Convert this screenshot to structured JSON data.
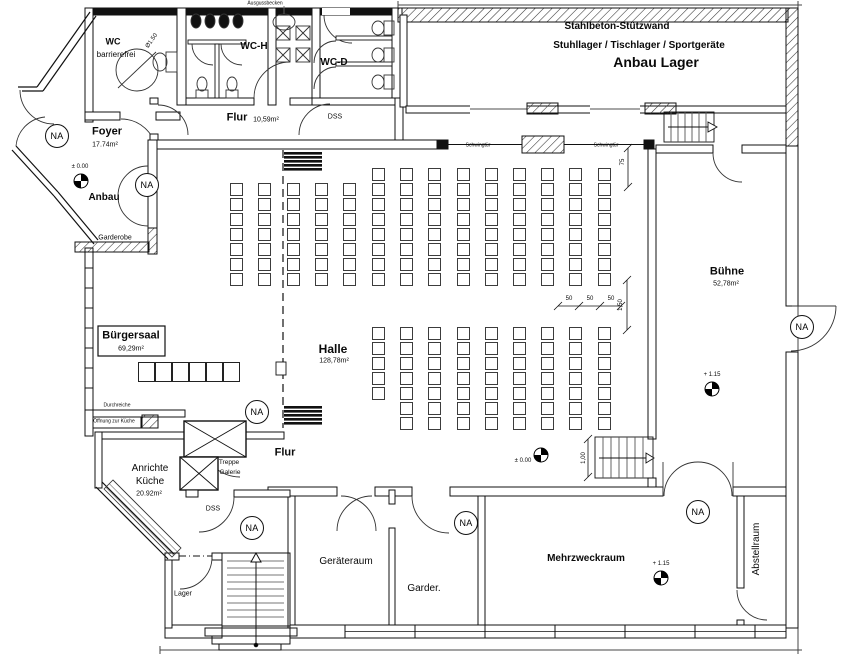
{
  "na_label": "NA",
  "labels": [
    {
      "id": "ausgussbecken",
      "text": "Ausgussbecken",
      "x": 265,
      "y": 4,
      "size": 5
    },
    {
      "id": "wc-line1",
      "text": "WC",
      "x": 113,
      "y": 42,
      "size": 9,
      "weight": 700
    },
    {
      "id": "wc-line2",
      "text": "barrierefrei",
      "x": 116,
      "y": 55,
      "size": 8
    },
    {
      "id": "durchmesser-150",
      "text": "Ø1.50",
      "x": 152,
      "y": 41,
      "size": 6,
      "rot": -55
    },
    {
      "id": "wc-h",
      "text": "WC-H",
      "x": 254,
      "y": 47,
      "size": 10,
      "weight": 700
    },
    {
      "id": "wc-d",
      "text": "WC-D",
      "x": 334,
      "y": 63,
      "size": 10,
      "weight": 700
    },
    {
      "id": "flur-top",
      "text": "Flur",
      "x": 237,
      "y": 118,
      "size": 11,
      "weight": 700
    },
    {
      "id": "flur-top-area",
      "text": "10,59m²",
      "x": 266,
      "y": 120,
      "size": 7
    },
    {
      "id": "dss-top",
      "text": "DSS",
      "x": 335,
      "y": 117,
      "size": 7
    },
    {
      "id": "stahlbeton",
      "text": "Stahlbeton-Stützwand",
      "x": 617,
      "y": 27,
      "size": 10,
      "weight": 700
    },
    {
      "id": "stuhllager",
      "text": "Stuhllager / Tischlager / Sportgeräte",
      "x": 639,
      "y": 46,
      "size": 10,
      "weight": 700
    },
    {
      "id": "anbau-lager",
      "text": "Anbau Lager",
      "x": 656,
      "y": 62,
      "size": 14,
      "weight": 800
    },
    {
      "id": "foyer",
      "text": "Foyer",
      "x": 107,
      "y": 132,
      "size": 11,
      "weight": 700
    },
    {
      "id": "foyer-area",
      "text": "17.74m²",
      "x": 105,
      "y": 145,
      "size": 7
    },
    {
      "id": "lvl-anbau-txt",
      "text": "± 0.00",
      "x": 80,
      "y": 167,
      "size": 6
    },
    {
      "id": "anbau",
      "text": "Anbau",
      "x": 104,
      "y": 198,
      "size": 10,
      "weight": 700
    },
    {
      "id": "garderobe",
      "text": "Garderobe",
      "x": 115,
      "y": 238,
      "size": 7
    },
    {
      "id": "buergersaal",
      "text": "Bürgersaal",
      "x": 131,
      "y": 336,
      "size": 11,
      "weight": 700
    },
    {
      "id": "buergersaal-area",
      "text": "69,29m²",
      "x": 131,
      "y": 349,
      "size": 7
    },
    {
      "id": "halle",
      "text": "Halle",
      "x": 333,
      "y": 349,
      "size": 12,
      "weight": 700
    },
    {
      "id": "halle-area",
      "text": "128,78m²",
      "x": 334,
      "y": 361,
      "size": 7
    },
    {
      "id": "buehne",
      "text": "Bühne",
      "x": 727,
      "y": 272,
      "size": 11,
      "weight": 700
    },
    {
      "id": "buehne-area",
      "text": "52,78m²",
      "x": 726,
      "y": 284,
      "size": 7
    },
    {
      "id": "lvl-buehne-txt",
      "text": "+ 1.15",
      "x": 712,
      "y": 375,
      "size": 6
    },
    {
      "id": "schwingtuer-1",
      "text": "Schwingtür",
      "x": 478,
      "y": 146,
      "size": 5
    },
    {
      "id": "schwingtuer-2",
      "text": "Schwingtür",
      "x": 606,
      "y": 146,
      "size": 5
    },
    {
      "id": "dim-75",
      "text": "75",
      "x": 623,
      "y": 162,
      "size": 6,
      "rot": -90
    },
    {
      "id": "dim-50-a",
      "text": "50",
      "x": 569,
      "y": 299,
      "size": 6
    },
    {
      "id": "dim-50-b",
      "text": "50",
      "x": 590,
      "y": 299,
      "size": 6
    },
    {
      "id": "dim-50-c",
      "text": "50",
      "x": 611,
      "y": 299,
      "size": 6
    },
    {
      "id": "dim-150",
      "text": "1,50",
      "x": 621,
      "y": 305,
      "size": 6,
      "rot": -90
    },
    {
      "id": "dim-100",
      "text": "1,00",
      "x": 584,
      "y": 458,
      "size": 6,
      "rot": -90
    },
    {
      "id": "lvl-halle-txt",
      "text": "± 0.00",
      "x": 523,
      "y": 461,
      "size": 6
    },
    {
      "id": "durchreiche",
      "text": "Durchreiche",
      "x": 117,
      "y": 406,
      "size": 5
    },
    {
      "id": "oeffnung-kueche",
      "text": "Öffnung zur Küche",
      "x": 114,
      "y": 422,
      "size": 5
    },
    {
      "id": "treppe",
      "text": "Treppe",
      "x": 229,
      "y": 463,
      "size": 6.5
    },
    {
      "id": "galerie",
      "text": "Galerie",
      "x": 230,
      "y": 473,
      "size": 6.5
    },
    {
      "id": "flur-mid",
      "text": "Flur",
      "x": 285,
      "y": 453,
      "size": 11,
      "weight": 700
    },
    {
      "id": "anrichte",
      "text": "Anrichte",
      "x": 150,
      "y": 469,
      "size": 10
    },
    {
      "id": "kueche",
      "text": "Küche",
      "x": 150,
      "y": 482,
      "size": 10
    },
    {
      "id": "kueche-area",
      "text": "20.92m²",
      "x": 149,
      "y": 494,
      "size": 7
    },
    {
      "id": "dss-mid",
      "text": "DSS",
      "x": 213,
      "y": 509,
      "size": 7
    },
    {
      "id": "lager",
      "text": "Lager",
      "x": 183,
      "y": 594,
      "size": 7
    },
    {
      "id": "geraeteraum",
      "text": "Geräteraum",
      "x": 346,
      "y": 562,
      "size": 10
    },
    {
      "id": "garder",
      "text": "Garder.",
      "x": 424,
      "y": 589,
      "size": 10
    },
    {
      "id": "mehrzweckraum",
      "text": "Mehrzweckraum",
      "x": 586,
      "y": 559,
      "size": 10,
      "weight": 700
    },
    {
      "id": "lvl-mzr-txt",
      "text": "+ 1.15",
      "x": 661,
      "y": 564,
      "size": 6
    },
    {
      "id": "abstellraum",
      "text": "Abstellraum",
      "x": 757,
      "y": 549,
      "size": 10,
      "rot": -90
    }
  ],
  "na_markers": [
    {
      "x": 57,
      "y": 136
    },
    {
      "x": 147,
      "y": 185
    },
    {
      "x": 257,
      "y": 412
    },
    {
      "x": 252,
      "y": 528
    },
    {
      "x": 466,
      "y": 523
    },
    {
      "x": 698,
      "y": 512
    },
    {
      "x": 802,
      "y": 327
    }
  ],
  "level_markers": [
    {
      "x": 81,
      "y": 181
    },
    {
      "x": 541,
      "y": 455
    },
    {
      "x": 712,
      "y": 389
    },
    {
      "x": 661,
      "y": 578
    }
  ],
  "seating": {
    "chair_w": 13,
    "chair_h": 13,
    "pitch_y": 15,
    "upper_columns": [
      {
        "x": 230,
        "y": 183,
        "rows": 7
      },
      {
        "x": 258,
        "y": 183,
        "rows": 7
      },
      {
        "x": 287,
        "y": 183,
        "rows": 7
      },
      {
        "x": 315,
        "y": 183,
        "rows": 7
      },
      {
        "x": 343,
        "y": 183,
        "rows": 7
      },
      {
        "x": 372,
        "y": 168,
        "rows": 8
      },
      {
        "x": 400,
        "y": 168,
        "rows": 8
      },
      {
        "x": 428,
        "y": 168,
        "rows": 8
      },
      {
        "x": 457,
        "y": 168,
        "rows": 8
      },
      {
        "x": 485,
        "y": 168,
        "rows": 8
      },
      {
        "x": 513,
        "y": 168,
        "rows": 8
      },
      {
        "x": 541,
        "y": 168,
        "rows": 8
      },
      {
        "x": 569,
        "y": 168,
        "rows": 8
      },
      {
        "x": 598,
        "y": 168,
        "rows": 8
      }
    ],
    "lower_columns": [
      {
        "x": 372,
        "y": 327,
        "rows": 5
      },
      {
        "x": 400,
        "y": 327,
        "rows": 7
      },
      {
        "x": 428,
        "y": 327,
        "rows": 7
      },
      {
        "x": 457,
        "y": 327,
        "rows": 7
      },
      {
        "x": 485,
        "y": 327,
        "rows": 7
      },
      {
        "x": 513,
        "y": 327,
        "rows": 7
      },
      {
        "x": 541,
        "y": 327,
        "rows": 7
      },
      {
        "x": 569,
        "y": 327,
        "rows": 7
      },
      {
        "x": 598,
        "y": 327,
        "rows": 7
      }
    ]
  },
  "tables": {
    "x": 138,
    "y": 362,
    "count": 6,
    "w": 17,
    "h": 20
  }
}
